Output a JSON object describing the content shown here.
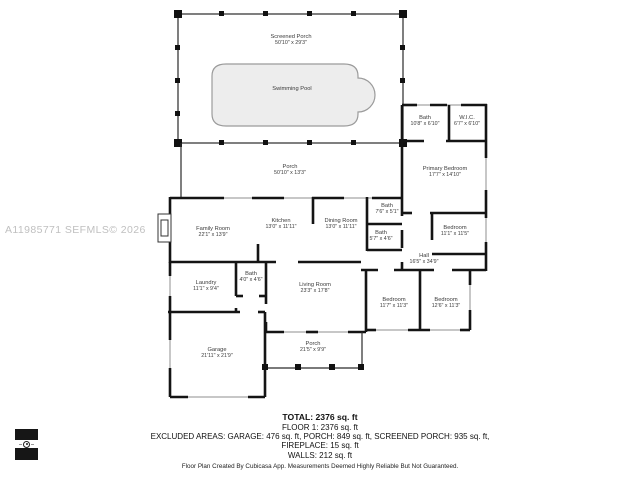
{
  "watermark": "A11985771  SEFMLS© 2026",
  "rooms": {
    "screened_porch": {
      "name": "Screened Porch",
      "dims": "50'10\" x 29'3\""
    },
    "swimming_pool": {
      "name": "Swimming Pool",
      "dims": ""
    },
    "porch_top": {
      "name": "Porch",
      "dims": "50'10\" x 13'3\""
    },
    "bath_a": {
      "name": "Bath",
      "dims": "10'8\" x 6'10\""
    },
    "wic": {
      "name": "W.I.C.",
      "dims": "6'7\" x 6'10\""
    },
    "primary_bedroom": {
      "name": "Primary Bedroom",
      "dims": "17'7\" x 14'10\""
    },
    "family_room": {
      "name": "Family Room",
      "dims": "22'1\" x 13'9\""
    },
    "kitchen": {
      "name": "Kitchen",
      "dims": "13'0\" x 11'11\""
    },
    "dining_room": {
      "name": "Dining Room",
      "dims": "13'0\" x 11'11\""
    },
    "bath_b": {
      "name": "Bath",
      "dims": "7'6\" x 5'1\""
    },
    "bath_c": {
      "name": "Bath",
      "dims": "5'7\" x 4'6\""
    },
    "bedroom_mid": {
      "name": "Bedroom",
      "dims": "11'1\" x 11'5\""
    },
    "hall": {
      "name": "Hall",
      "dims": "16'5\" x 34'9\""
    },
    "laundry": {
      "name": "Laundry",
      "dims": "11'1\" x 9'4\""
    },
    "bath_d": {
      "name": "Bath",
      "dims": "4'0\" x 4'6\""
    },
    "living_room": {
      "name": "Living Room",
      "dims": "23'3\" x 17'8\""
    },
    "bedroom_b": {
      "name": "Bedroom",
      "dims": "11'7\" x 11'3\""
    },
    "bedroom_c": {
      "name": "Bedroom",
      "dims": "12'6\" x 11'3\""
    },
    "garage": {
      "name": "Garage",
      "dims": "21'11\" x 21'9\""
    },
    "porch_bottom": {
      "name": "Porch",
      "dims": "21'5\" x 9'9\""
    }
  },
  "summary": {
    "total": "TOTAL: 2376 sq. ft",
    "floor": "FLOOR 1: 2376 sq. ft",
    "excluded": "EXCLUDED AREAS: GARAGE: 476 sq. ft, PORCH: 849 sq. ft, SCREENED PORCH: 935 sq. ft,",
    "fireplace": "FIREPLACE: 15 sq. ft",
    "walls": "WALLS: 212 sq. ft",
    "disclaimer": "Floor Plan Created By Cubicasa App. Measurements Deemed Highly Reliable But Not Guaranteed."
  },
  "colors": {
    "wall": "#141414",
    "pool_fill": "#ededed",
    "pool_stroke": "#9b9b9b",
    "watermark_text": "#c0c0c0",
    "label_text": "#3a3a3a"
  }
}
